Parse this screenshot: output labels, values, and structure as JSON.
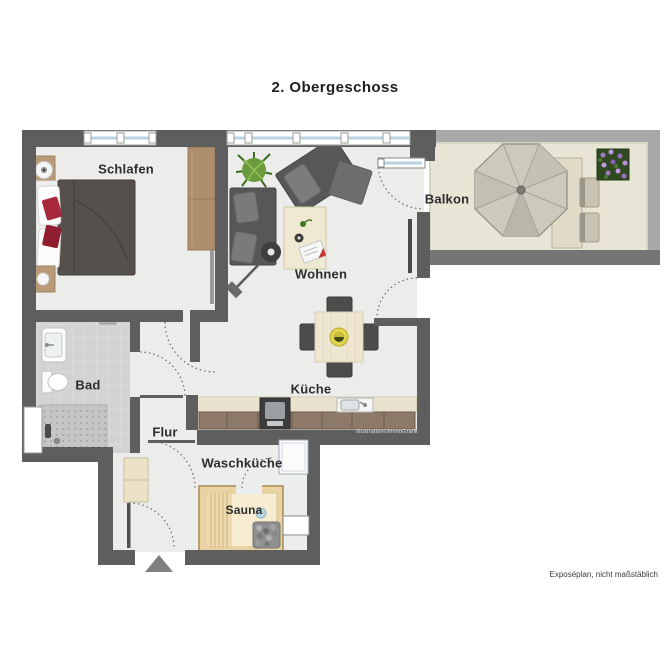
{
  "title": "2. Obergeschoss",
  "rooms": {
    "schlafen": {
      "label": "Schlafen"
    },
    "wohnen": {
      "label": "Wohnen"
    },
    "balkon": {
      "label": "Balkon"
    },
    "bad": {
      "label": "Bad"
    },
    "kueche": {
      "label": "Küche"
    },
    "flur": {
      "label": "Flur"
    },
    "waschkueche": {
      "label": "Waschküche"
    },
    "sauna": {
      "label": "Sauna"
    }
  },
  "watermark": "Illustration©immoGrafik",
  "footer_note": "Exposéplan, nicht maßstäblich",
  "furniture": {
    "schlafen": [
      "double-bed",
      "nightstand",
      "nightstand",
      "table-lamp",
      "wardrobe",
      "sliding-door"
    ],
    "wohnen": [
      "sofa",
      "armchair",
      "ottoman",
      "coffee-table",
      "floor-lamp",
      "potted-plant",
      "tv-sideboard"
    ],
    "kueche": [
      "kitchen-counter",
      "stove",
      "sink",
      "dining-table",
      "chair",
      "chair",
      "chair",
      "chair"
    ],
    "bad": [
      "washbasin",
      "toilet",
      "shower",
      "radiator",
      "window"
    ],
    "flur": [
      "hall-cabinet",
      "entrance-door"
    ],
    "waschkueche": [
      "washing-machine",
      "niche"
    ],
    "sauna": [
      "sauna-bench",
      "sauna-heater",
      "bucket"
    ],
    "balkon": [
      "parasol",
      "garden-table",
      "chair",
      "chair",
      "flower-box"
    ]
  },
  "colors": {
    "wall": "#5e5e5e",
    "railing": "#a9a9a9",
    "floor": "#ecedea",
    "bath_tile": "#d2d3d2",
    "balcony_floor": "#e8e4d6",
    "wood": "#ad8f6e",
    "sauna_wood": "#e9d3a2",
    "accent_red": "#a8293b"
  }
}
